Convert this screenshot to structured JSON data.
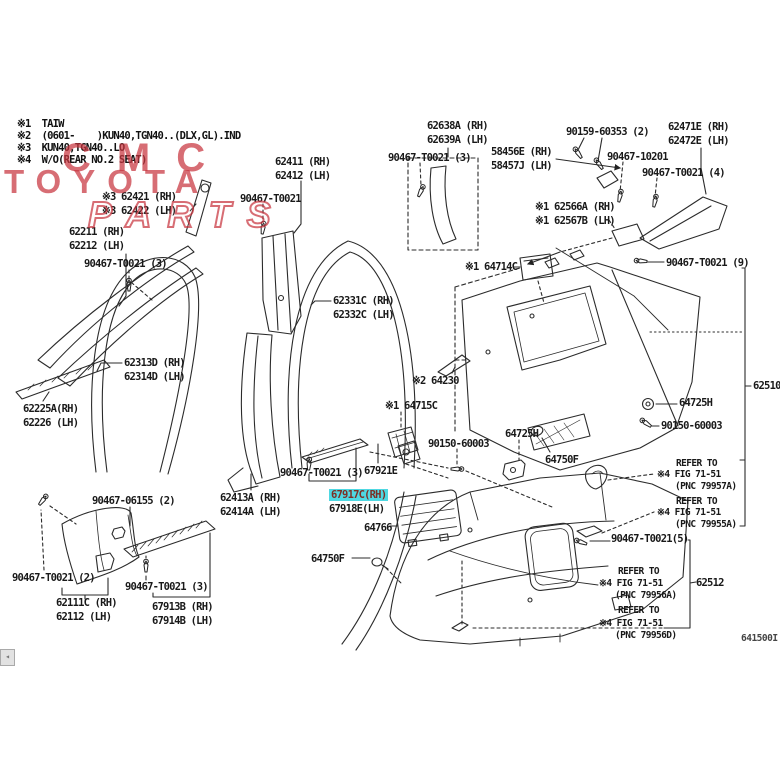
{
  "watermark": {
    "line1": "CMC",
    "line2": "TOYOTA",
    "line3": "PARTS",
    "color": "#c8353f"
  },
  "notes": [
    {
      "text": "※1  TAIW",
      "x": 17,
      "y": 119
    },
    {
      "text": "※2  (0601-    )KUN40,TGN40..(DLX,GL).IND",
      "x": 17,
      "y": 131
    },
    {
      "text": "※3  KUN40,TGN40..LO",
      "x": 17,
      "y": 143
    },
    {
      "text": "※4  W/O(REAR NO.2 SEAT)",
      "x": 17,
      "y": 155
    }
  ],
  "highlight_colors": {
    "background": "#4fd8e2",
    "text": "#7d2f25"
  },
  "diagram_code": "641500I",
  "ui": {
    "corner_arrow": "◂"
  },
  "labels": [
    {
      "text": "62638A (RH)",
      "x": 427,
      "y": 120
    },
    {
      "text": "62639A (LH)",
      "x": 427,
      "y": 134
    },
    {
      "text": "90467-T0021 (3)",
      "x": 388,
      "y": 152
    },
    {
      "text": "58456E (RH)",
      "x": 491,
      "y": 146
    },
    {
      "text": "58457J (LH)",
      "x": 491,
      "y": 160
    },
    {
      "text": "90159-60353 (2)",
      "x": 566,
      "y": 126
    },
    {
      "text": "62471E (RH)",
      "x": 668,
      "y": 121
    },
    {
      "text": "62472E (LH)",
      "x": 668,
      "y": 135
    },
    {
      "text": "90467-10201",
      "x": 607,
      "y": 151
    },
    {
      "text": "90467-T0021 (4)",
      "x": 642,
      "y": 167
    },
    {
      "text": "※1 62566A (RH)",
      "x": 535,
      "y": 201
    },
    {
      "text": "※1 62567B (LH)",
      "x": 535,
      "y": 215
    },
    {
      "text": "62411 (RH)",
      "x": 275,
      "y": 156
    },
    {
      "text": "62412 (LH)",
      "x": 275,
      "y": 170
    },
    {
      "text": "90467-T0021",
      "x": 240,
      "y": 193
    },
    {
      "text": "※3 62421 (RH)",
      "x": 102,
      "y": 191
    },
    {
      "text": "※3 62422 (LH)",
      "x": 102,
      "y": 205
    },
    {
      "text": "62211 (RH)",
      "x": 69,
      "y": 226
    },
    {
      "text": "62212 (LH)",
      "x": 69,
      "y": 240
    },
    {
      "text": "90467-T0021 (3)",
      "x": 84,
      "y": 258
    },
    {
      "text": "62331C (RH)",
      "x": 333,
      "y": 295
    },
    {
      "text": "62332C (LH)",
      "x": 333,
      "y": 309
    },
    {
      "text": "62313D (RH)",
      "x": 124,
      "y": 357
    },
    {
      "text": "62314D (LH)",
      "x": 124,
      "y": 371
    },
    {
      "text": "62225A(RH)",
      "x": 23,
      "y": 403
    },
    {
      "text": "62226 (LH)",
      "x": 23,
      "y": 417
    },
    {
      "text": "※1 64714C",
      "x": 465,
      "y": 261
    },
    {
      "text": "90467-T0021 (9)",
      "x": 666,
      "y": 257
    },
    {
      "text": "62510",
      "x": 753,
      "y": 380
    },
    {
      "text": "※2 64230",
      "x": 412,
      "y": 375
    },
    {
      "text": "※1 64715C",
      "x": 385,
      "y": 400
    },
    {
      "text": "90150-60003",
      "x": 428,
      "y": 438
    },
    {
      "text": "64725H",
      "x": 679,
      "y": 397
    },
    {
      "text": "90150-60003",
      "x": 661,
      "y": 420
    },
    {
      "text": "64725H",
      "x": 505,
      "y": 428
    },
    {
      "text": "64750F",
      "x": 545,
      "y": 454
    },
    {
      "text": "90467-T0021 (3)",
      "x": 280,
      "y": 467
    },
    {
      "text": "67921E",
      "x": 364,
      "y": 465
    },
    {
      "text": "67917C(RH)",
      "x": 329,
      "y": 489,
      "style": "hl",
      "name": "part-label-selected"
    },
    {
      "text": "67918E(LH)",
      "x": 329,
      "y": 503
    },
    {
      "text": "64766",
      "x": 364,
      "y": 522
    },
    {
      "text": "62413A (RH)",
      "x": 220,
      "y": 492
    },
    {
      "text": "62414A (LH)",
      "x": 220,
      "y": 506
    },
    {
      "text": "90467-06155 (2)",
      "x": 92,
      "y": 495
    },
    {
      "text": "90467-T0021 (2)",
      "x": 12,
      "y": 572
    },
    {
      "text": "62111C (RH)",
      "x": 56,
      "y": 597
    },
    {
      "text": "62112 (LH)",
      "x": 56,
      "y": 611
    },
    {
      "text": "90467-T0021 (3)",
      "x": 125,
      "y": 581
    },
    {
      "text": "67913B (RH)",
      "x": 152,
      "y": 601
    },
    {
      "text": "67914B (LH)",
      "x": 152,
      "y": 615
    },
    {
      "text": "64750F",
      "x": 311,
      "y": 553
    },
    {
      "text": "90467-T0021(5)",
      "x": 611,
      "y": 533
    },
    {
      "text": "REFER TO",
      "x": 676,
      "y": 459,
      "style": "small"
    },
    {
      "text": "※4 FIG 71-51",
      "x": 657,
      "y": 470,
      "style": "small"
    },
    {
      "text": "(PNC 79957A)",
      "x": 675,
      "y": 482,
      "style": "small"
    },
    {
      "text": "REFER TO",
      "x": 676,
      "y": 497,
      "style": "small"
    },
    {
      "text": "※4 FIG 71-51",
      "x": 657,
      "y": 508,
      "style": "small"
    },
    {
      "text": "(PNC 79955A)",
      "x": 675,
      "y": 520,
      "style": "small"
    },
    {
      "text": "REFER TO",
      "x": 618,
      "y": 567,
      "style": "small"
    },
    {
      "text": "※4 FIG 71-51",
      "x": 599,
      "y": 579,
      "style": "small"
    },
    {
      "text": "(PNC 79956A)",
      "x": 615,
      "y": 591,
      "style": "small"
    },
    {
      "text": "62512",
      "x": 696,
      "y": 577
    },
    {
      "text": "REFER TO",
      "x": 618,
      "y": 606,
      "style": "small"
    },
    {
      "text": "※4 FIG 71-51",
      "x": 599,
      "y": 619,
      "style": "small"
    },
    {
      "text": "(PNC 79956D)",
      "x": 615,
      "y": 631,
      "style": "small"
    }
  ]
}
